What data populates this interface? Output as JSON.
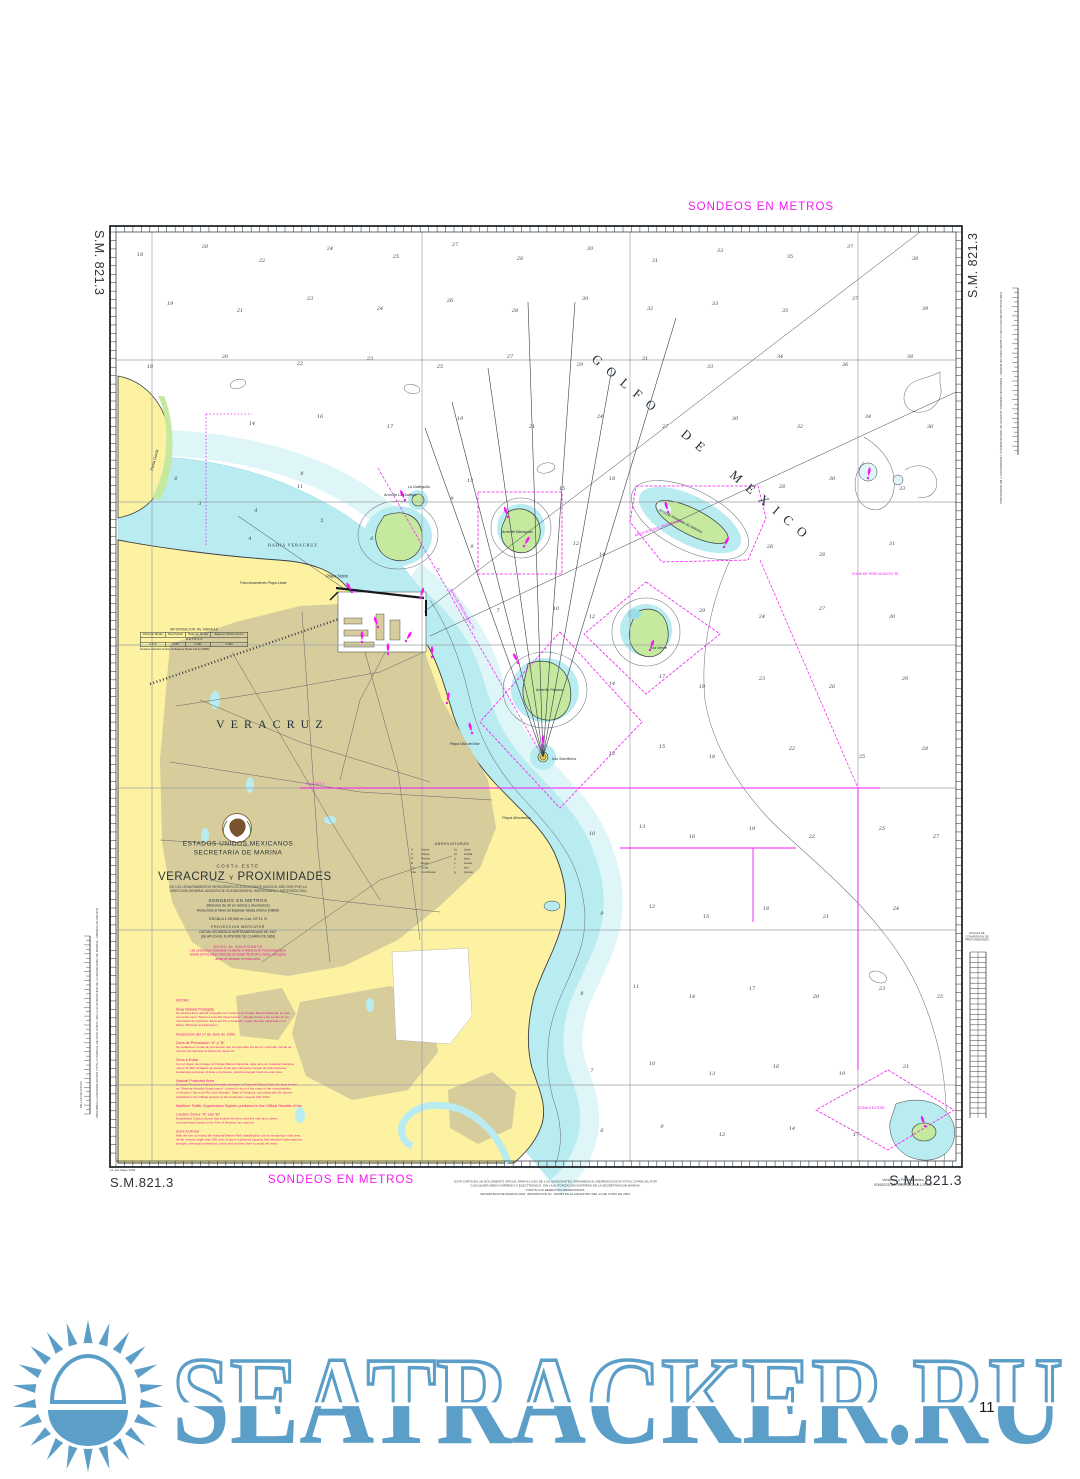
{
  "colors": {
    "magenta": "#f318f3",
    "note": "#e9188c",
    "land": "#fcf2a2",
    "urban": "#d6cc9c",
    "shallow": "#b9ecf1",
    "shallow_light": "#dff6f8",
    "reef": "#c6e9a0",
    "watermark": "#5b9ec8"
  },
  "frame": {
    "sm_top_left": "S.M. 821.3",
    "sm_top_right": "S.M. 821.3",
    "sm_bottom_left": "S.M.821.3",
    "sm_bottom_right": "S.M. 821.3",
    "sondeos_top": "SONDEOS EN METROS",
    "sondeos_bottom": "SONDEOS EN METROS",
    "edition_note": "1a. Ed. Mayo 2003",
    "bottom_right_title": "Veracruz y Proximidades",
    "bottom_right_sub": "SONDEOS-METROS      ESCALA 1:25,000",
    "copyright_lines": [
      "ESTA CARTA ES UN DOCUMENTO OFICIAL PARA EL USO DE LOS NAVEGANTES; PROHIBIDA SU REPRODUCCION TOTAL O PARCIAL POR",
      "CUALQUIER MEDIO IMPRESO O ELECTRONICO, SIN LA AUTORIZACION EXPRESA DE LA SECRETARIA DE MARINA.",
      "TODOS LOS DERECHOS RESERVADOS.",
      "SECRETARIA DE MARINA 2003. INSCRIPCION No. 032003 EN EL REGISTRO DEL 14 DE JUNIO DE 2004."
    ],
    "left_margin_note": "PROHIBIDA LA REPRODUCCION TOTAL O PARCIAL DE ESTA CARTA, SIN LA AUTORIZACION DE LA SECRETARIA DE MARINA - ARMADA DE MEXICO",
    "right_margin_note": "PUBLICADA EN MEXICO POR LA SECRETARIA DE MARINA - DIRECCION GENERAL ADJUNTA DE OCEANOGRAFIA, HIDROGRAFIA Y METEOROLOGIA",
    "lat_scale_title": "MILLAS NAUTICAS",
    "depth_scale_lines": [
      "ESCALA DE",
      "CONVERSION DE",
      "PROFUNDIDADES"
    ]
  },
  "title_block": {
    "country": "ESTADOS UNIDOS MEXICANOS",
    "agency": "SECRETARIA DE MARINA",
    "region": "COSTA ESTE",
    "title_main": "VERACRUZ",
    "title_conj": "Y",
    "title_rest": "PROXIMIDADES",
    "src1": "DE LOS LEVANTAMIENTOS HIDROGRAFICOS EJECUTADOS HASTA EL AÑO 2000 POR LA",
    "src2": "DIRECCION GENERAL ADJUNTA DE OCEANOGRAFIA, HIDROGRAFIA Y METEOROLOGIA",
    "sondeos": "SONDEOS EN METROS",
    "sondeos_sub1": "(Menores de 30 en metros y decímetros)",
    "sondeos_sub2": "Reducidos al Nivel de Bajamar Media Inferior (NBMI)",
    "escala": "ESCALA 1:25,000 en Lat. 19°11' N",
    "proy": "PROYECCION MERCATOR",
    "datum1": "DATUM GEODESICO NORTEAMERICANO DE 1927",
    "datum2": "(SE APLICA EL ELIPSOIDE DE CLARKE DE 1866)",
    "aviso_heading": "AVISO AL NAVEGANTE",
    "aviso_lines": [
      "Las posiciones obtenidas mediante el Sistema de Posicionamiento",
      "Global (GPS) están referidas al Datum WGS-84 y deben corregirse",
      "antes de situarse en esta carta."
    ]
  },
  "tide_table": {
    "title": "INFORMACION DE MAREAS",
    "unit_row": "M E T R O S",
    "headers": [
      "Pleamar Media",
      "Nivel Medio",
      "Bajamar Media",
      "Bajamar Media Inferior"
    ],
    "values": [
      "0.476",
      "0.287",
      "0.091",
      "0.000"
    ],
    "footnote": "Sondeos referidos al Nivel de Bajamar Media Inferior (NBMI)"
  },
  "abbreviations": {
    "title": "ABREVIATURAS",
    "items": [
      [
        "A",
        "Arena"
      ],
      [
        "F",
        "Fango"
      ],
      [
        "P",
        "Piedra"
      ],
      [
        "R",
        "Roca"
      ],
      [
        "Co",
        "Coral"
      ],
      [
        "Cta",
        "Conchuela"
      ],
      [
        "Lv",
        "Lava"
      ],
      [
        "Ar",
        "Arcilla"
      ],
      [
        "d",
        "duro"
      ],
      [
        "s",
        "suave"
      ],
      [
        "f",
        "fino"
      ],
      [
        "g",
        "grueso"
      ]
    ]
  },
  "notes": {
    "sections": [
      {
        "h": "NOTAS:",
        "b": []
      },
      {
        "h": "Área Natural Protegida",
        "b": [
          "Se declara área natural protegida con carácter de Parque Marino Nacional, la zona",
          "conocida como \"Sistema Arrecifal Veracruzano\", ubicada frente a las costas de los",
          "municipios de Veracruz, Boca del Río y Alvarado, según decreto publicado en el",
          "Diario Oficial de la Federación."
        ]
      },
      {
        "h": "Federación del 17 de Julio de 1998.",
        "b": []
      },
      {
        "h": "Zona de Precaución \"A\" y \"B\"",
        "b": [
          "Se establecen zonas de precaución que comprenden los arcos y derrotas, donde se",
          "norman las derrotas al Puerto de Veracruz."
        ]
      },
      {
        "h": "Zona a Evitar",
        "b": [
          "Con el objeto de proteger el Parque Marino Nacional, toda nave de cualquier bandera,",
          "mayor de 500 unidades de arqueo bruto que transporte cargas de hidrocarburos,",
          "sustancias químicas, tóxicas o nucleares, deberá navegar fuera de esta zona."
        ]
      },
      {
        "h": "Natural Protected Area",
        "b": [
          "Declared Protected Natural Area with character of National Marine Park, the area known",
          "as \"Sistema Arrecifal Veracruzano\", located in front of the coast of the municipalities",
          "of Veracruz, Boca del Río and Alvarado, State of Veracruz, according with the decree",
          "published in the Official Gazette of the Federation, August 24th 1992."
        ]
      },
      {
        "h": "Maritime Traffic Organization System published in the Official Gazette of the",
        "b": []
      },
      {
        "h": "Caution Zones \"A\" and \"B\"",
        "b": [
          "Established Caution Zones that include the three and five mile arcs, where",
          "recommended routes to the Port of Veracruz are normed."
        ]
      },
      {
        "h": "Zone to Avoid",
        "b": [
          "With the aim to protect the National Marine Park classification not be remaining in this area,",
          "all the vessels larger than 500 units of gross registered capacity that transport hydrocarbons",
          "charges, chemical substances, toxics and nuclear, have to avoid this area."
        ]
      }
    ]
  },
  "map": {
    "labels": [
      {
        "t": "GOLFO DE MEXICO",
        "x": 598,
        "y": 352,
        "s": 13,
        "r": 40,
        "ls": 9,
        "ws": 16,
        "f": 1
      },
      {
        "t": "VERACRUZ",
        "x": 216,
        "y": 718,
        "s": 12,
        "ls": 6,
        "f": 1
      },
      {
        "t": "BAHIA VERACRUZ",
        "x": 268,
        "y": 543,
        "s": 4.5,
        "ls": 1.5,
        "f": 1
      },
      {
        "t": "Playa Norte",
        "x": 326,
        "y": 574,
        "s": 4.2,
        "i": 1
      },
      {
        "t": "Fraccionamiento Playa Linda",
        "x": 240,
        "y": 581,
        "s": 3.6,
        "i": 1
      },
      {
        "t": "Arrecife La Gallega",
        "x": 384,
        "y": 493,
        "s": 3.8,
        "i": 1
      },
      {
        "t": "La Galleguilla",
        "x": 408,
        "y": 485,
        "s": 3.6,
        "i": 1
      },
      {
        "t": "Arrecife Blanquilla",
        "x": 502,
        "y": 530,
        "s": 3.8,
        "i": 1
      },
      {
        "t": "Arrecife Anegada de Adentro",
        "x": 660,
        "y": 508,
        "s": 3.8,
        "i": 1,
        "r": 28
      },
      {
        "t": "AREA NATURAL PROTEGIDA",
        "x": 634,
        "y": 534,
        "s": 3.6,
        "c": "magenta",
        "r": -18
      },
      {
        "t": "Isla Verde",
        "x": 650,
        "y": 646,
        "s": 3.8,
        "i": 1
      },
      {
        "t": "Arrecife Pájaros",
        "x": 536,
        "y": 688,
        "s": 3.8,
        "i": 1
      },
      {
        "t": "Isla Sacrificios",
        "x": 552,
        "y": 757,
        "s": 3.8,
        "i": 1
      },
      {
        "t": "Playa Mocambo",
        "x": 502,
        "y": 816,
        "s": 4,
        "i": 1
      },
      {
        "t": "Playa Villa del Mar",
        "x": 450,
        "y": 742,
        "s": 3.6,
        "i": 1
      },
      {
        "t": "Punta Gorda",
        "x": 150,
        "y": 470,
        "s": 3.8,
        "i": 1,
        "r": -75
      },
      {
        "t": "S.M. 827.1",
        "x": 306,
        "y": 782,
        "s": 3.8,
        "c": "magenta"
      },
      {
        "t": "ZONA DE PRECAUCION \"A\"",
        "x": 452,
        "y": 588,
        "s": 3.6,
        "c": "magenta",
        "r": 60
      },
      {
        "t": "ZONA DE PRECAUCION \"B\"",
        "x": 852,
        "y": 572,
        "s": 3.6,
        "c": "magenta"
      },
      {
        "t": "ZONA A EVITAR",
        "x": 858,
        "y": 1106,
        "s": 3.6,
        "c": "magenta"
      }
    ],
    "soundings": [
      [
        140,
        256,
        "18"
      ],
      [
        205,
        248,
        "20"
      ],
      [
        262,
        262,
        "22"
      ],
      [
        330,
        250,
        "24"
      ],
      [
        396,
        258,
        "25"
      ],
      [
        455,
        246,
        "27"
      ],
      [
        520,
        260,
        "28"
      ],
      [
        590,
        250,
        "30"
      ],
      [
        655,
        262,
        "31"
      ],
      [
        720,
        252,
        "33"
      ],
      [
        790,
        258,
        "35"
      ],
      [
        850,
        248,
        "37"
      ],
      [
        915,
        260,
        "38"
      ],
      [
        170,
        305,
        "19"
      ],
      [
        240,
        312,
        "21"
      ],
      [
        310,
        300,
        "23"
      ],
      [
        380,
        310,
        "24"
      ],
      [
        450,
        302,
        "26"
      ],
      [
        515,
        312,
        "28"
      ],
      [
        585,
        300,
        "30"
      ],
      [
        650,
        310,
        "32"
      ],
      [
        715,
        305,
        "33"
      ],
      [
        785,
        312,
        "35"
      ],
      [
        855,
        300,
        "37"
      ],
      [
        925,
        310,
        "39"
      ],
      [
        150,
        368,
        "18"
      ],
      [
        225,
        358,
        "20"
      ],
      [
        300,
        365,
        "22"
      ],
      [
        370,
        360,
        "23"
      ],
      [
        440,
        368,
        "25"
      ],
      [
        510,
        358,
        "27"
      ],
      [
        580,
        366,
        "29"
      ],
      [
        645,
        360,
        "31"
      ],
      [
        710,
        368,
        "33"
      ],
      [
        780,
        358,
        "34"
      ],
      [
        845,
        366,
        "36"
      ],
      [
        910,
        358,
        "38"
      ],
      [
        252,
        425,
        "14"
      ],
      [
        320,
        418,
        "16"
      ],
      [
        390,
        428,
        "17"
      ],
      [
        460,
        420,
        "19"
      ],
      [
        532,
        428,
        "21"
      ],
      [
        600,
        418,
        "24"
      ],
      [
        665,
        428,
        "27"
      ],
      [
        735,
        420,
        "30"
      ],
      [
        800,
        428,
        "32"
      ],
      [
        868,
        418,
        "34"
      ],
      [
        930,
        428,
        "36"
      ],
      [
        300,
        488,
        "11"
      ],
      [
        470,
        482,
        "13"
      ],
      [
        562,
        490,
        "15"
      ],
      [
        612,
        480,
        "18"
      ],
      [
        782,
        488,
        "28"
      ],
      [
        832,
        480,
        "30"
      ],
      [
        902,
        490,
        "33"
      ],
      [
        472,
        548,
        "9"
      ],
      [
        576,
        545,
        "12"
      ],
      [
        602,
        556,
        "14"
      ],
      [
        770,
        548,
        "26"
      ],
      [
        822,
        556,
        "28"
      ],
      [
        892,
        545,
        "31"
      ],
      [
        498,
        612,
        "7"
      ],
      [
        556,
        610,
        "10"
      ],
      [
        592,
        618,
        "12"
      ],
      [
        702,
        612,
        "20"
      ],
      [
        762,
        618,
        "24"
      ],
      [
        822,
        610,
        "27"
      ],
      [
        892,
        618,
        "30"
      ],
      [
        612,
        685,
        "14"
      ],
      [
        662,
        678,
        "17"
      ],
      [
        702,
        688,
        "19"
      ],
      [
        762,
        680,
        "23"
      ],
      [
        832,
        688,
        "26"
      ],
      [
        905,
        680,
        "29"
      ],
      [
        612,
        755,
        "12"
      ],
      [
        662,
        748,
        "15"
      ],
      [
        712,
        758,
        "18"
      ],
      [
        792,
        750,
        "22"
      ],
      [
        862,
        758,
        "25"
      ],
      [
        925,
        750,
        "28"
      ],
      [
        592,
        835,
        "10"
      ],
      [
        642,
        828,
        "13"
      ],
      [
        692,
        838,
        "16"
      ],
      [
        752,
        830,
        "19"
      ],
      [
        812,
        838,
        "22"
      ],
      [
        882,
        830,
        "25"
      ],
      [
        936,
        838,
        "27"
      ],
      [
        602,
        915,
        "9"
      ],
      [
        652,
        908,
        "12"
      ],
      [
        706,
        918,
        "15"
      ],
      [
        766,
        910,
        "18"
      ],
      [
        826,
        918,
        "21"
      ],
      [
        896,
        910,
        "24"
      ],
      [
        582,
        995,
        "8"
      ],
      [
        636,
        988,
        "11"
      ],
      [
        692,
        998,
        "14"
      ],
      [
        752,
        990,
        "17"
      ],
      [
        816,
        998,
        "20"
      ],
      [
        882,
        990,
        "23"
      ],
      [
        940,
        998,
        "25"
      ],
      [
        592,
        1072,
        "7"
      ],
      [
        652,
        1065,
        "10"
      ],
      [
        712,
        1075,
        "13"
      ],
      [
        776,
        1068,
        "16"
      ],
      [
        842,
        1075,
        "19"
      ],
      [
        906,
        1068,
        "21"
      ],
      [
        602,
        1132,
        "6"
      ],
      [
        662,
        1128,
        "9"
      ],
      [
        722,
        1136,
        "12"
      ],
      [
        792,
        1130,
        "14"
      ],
      [
        856,
        1136,
        "17"
      ],
      [
        200,
        505,
        "3"
      ],
      [
        256,
        512,
        "4"
      ],
      [
        322,
        522,
        "5"
      ],
      [
        176,
        480,
        "6"
      ],
      [
        302,
        475,
        "8"
      ],
      [
        372,
        540,
        "6"
      ],
      [
        438,
        572,
        "7"
      ],
      [
        452,
        500,
        "9"
      ],
      [
        250,
        540,
        "4"
      ]
    ]
  },
  "watermark": {
    "text": "SEATRACKER.RU"
  },
  "page_number": "11"
}
